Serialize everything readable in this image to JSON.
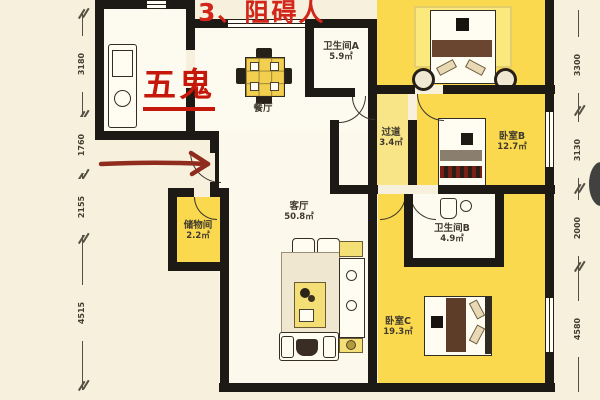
{
  "annotations": {
    "top_note": "3、阻碍人",
    "fengshui_label": "五鬼"
  },
  "rooms": {
    "dining": {
      "name": "餐厅",
      "area": ""
    },
    "bath_a": {
      "name": "卫生间A",
      "area": "5.9㎡"
    },
    "corridor": {
      "name": "过道",
      "area": "3.4㎡"
    },
    "bedroom_b": {
      "name": "卧室B",
      "area": "12.7㎡"
    },
    "bath_b": {
      "name": "卫生间B",
      "area": "4.9㎡"
    },
    "bedroom_c": {
      "name": "卧室C",
      "area": "19.3㎡"
    },
    "living": {
      "name": "客厅",
      "area": "50.8㎡"
    },
    "storage": {
      "name": "储物间",
      "area": "2.2㎡"
    }
  },
  "dimensions": {
    "left": [
      "3180",
      "1760",
      "2155",
      "4515"
    ],
    "right": [
      "3300",
      "3130",
      "2000",
      "4580"
    ]
  },
  "colors": {
    "highlight_yellow": "#fbd94f",
    "annotation_red": "#c5170a",
    "wall_black": "#1d1a16",
    "background_cream": "#f6f0dc"
  }
}
